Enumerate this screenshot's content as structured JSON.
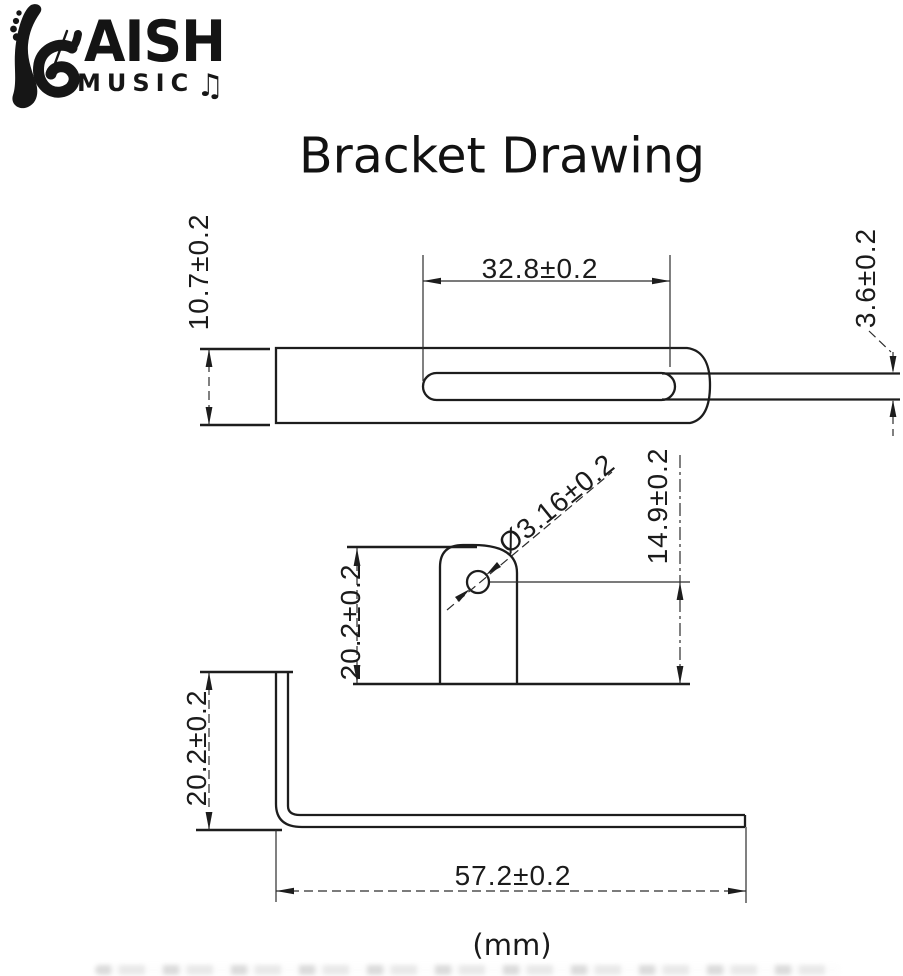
{
  "logo": {
    "brand": "AISH",
    "subtitle": "MUSIC",
    "note_icon": "♫"
  },
  "title": "Bracket Drawing",
  "units_label": "(mm)",
  "views": {
    "top": {
      "height": "10.7±0.2",
      "slot_length": "32.8±0.2",
      "slot_width": "3.6±0.2"
    },
    "front": {
      "hole_diameter": "Ø3.16±0.2",
      "hole_center_to_base": "14.9±0.2",
      "tab_height": "20.2±0.2"
    },
    "side": {
      "leg_height": "20.2±0.2",
      "base_length": "57.2±0.2"
    }
  }
}
